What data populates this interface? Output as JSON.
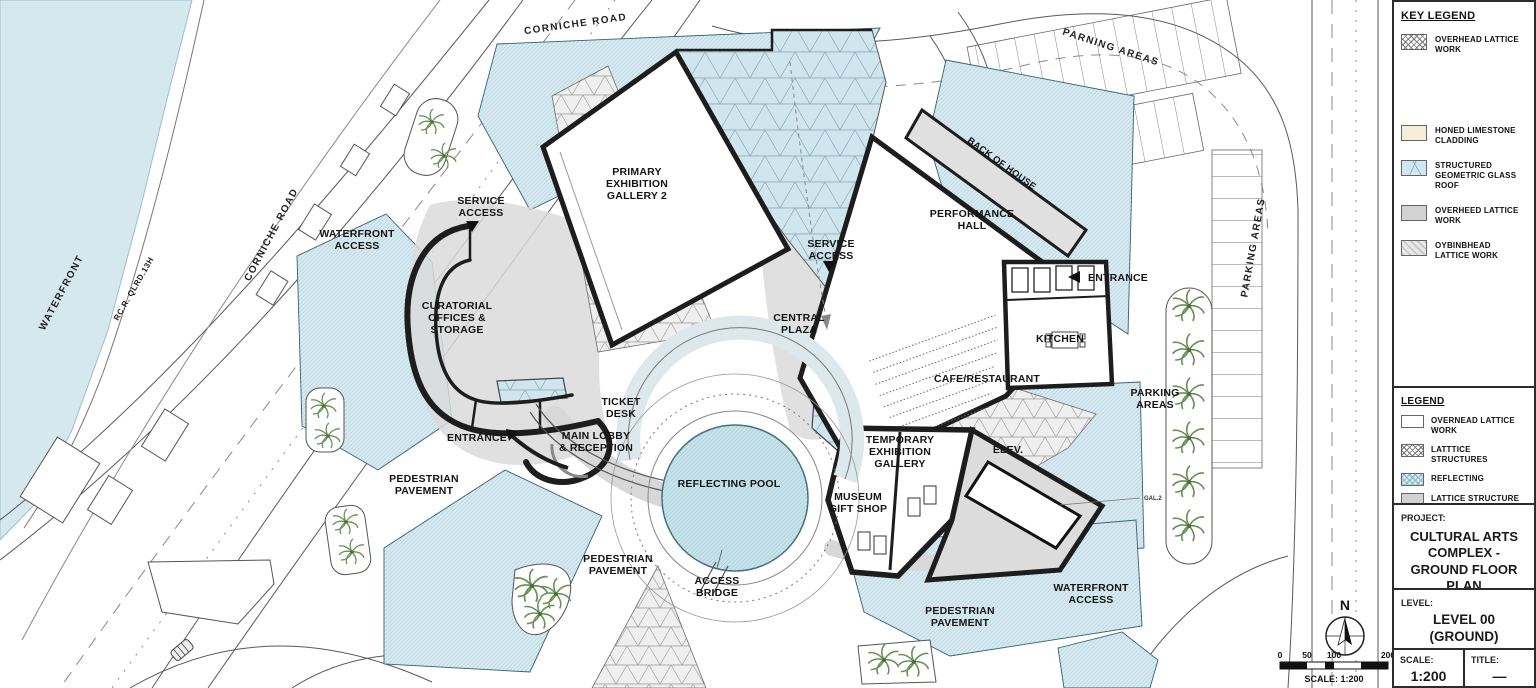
{
  "plan": {
    "labels": {
      "corniche_top": "CORNICHE ROAD",
      "parning_areas": "PARNING AREAS",
      "waterfront": "WATERFRONT",
      "rc_road": "RC.R. QLRD.13H",
      "corniche_left": "CORNICHE ROAD",
      "waterfront_access_nw": "WATERFRONT\nACCESS",
      "service_access_nw": "SERVICE\nACCESS",
      "primary_gallery": "PRIMARY\nEXHIBITION\nGALLERY 2",
      "service_access_c": "SERVICE\nACCESS",
      "performance_hall": "PERFORMANCE\nHALL",
      "back_of_house": "BACK OF HOUSE",
      "entrance_e": "ENTRANCE",
      "kitchen": "KITCHEN",
      "cafe": "CAFE/RESTAURANT",
      "curatorial": "CURATORIAL\nOFFICES &\nSTORAGE",
      "central_plaza": "CENTRAL\nPLAZA",
      "ticket_desk": "TICKET\nDESK",
      "main_lobby": "MAIN LOBBY\n& RECEPTION",
      "entrance_w": "ENTRANCE",
      "ped_pavement_w": "PEDESTRIAN\nPAVEMENT",
      "reflecting_pool": "REFLECTING POOL",
      "temp_gallery": "TEMPORARY\nEXHIBITION\nGALLERY",
      "elev": "ELEV.",
      "gift_shop": "MUSEUM\nGIFT SHOP",
      "parking_e": "PARKING\nAREAS",
      "ped_pavement_s": "PEDESTRIAN\nPAVEMENT",
      "access_bridge": "ACCESS\nBRIDGE",
      "ped_pavement_se": "PEDESTRIAN\nPAVEMENT",
      "waterfront_access_se": "WATERFRONT\nACCESS",
      "parking_right": "PARKING AREAS",
      "gal_tag": "GAL.2"
    },
    "north_label": "N",
    "scale_bar": {
      "ticks": [
        "0",
        "50",
        "100",
        "200"
      ],
      "caption": "SCALE: 1:200"
    }
  },
  "title_block": {
    "key_legend": {
      "title": "KEY LEGEND",
      "items": [
        {
          "label": "OVERHEAD LATTICE WORK",
          "swatch": "crosshatch"
        },
        {
          "label": "HONED LIMESTONE CLADDING",
          "swatch": "limestone"
        },
        {
          "label": "STRUCTURED GEOMETRIC GLASS ROOF",
          "swatch": "glass"
        },
        {
          "label": "OVERHEED LATTICE WORK",
          "swatch": "gray"
        },
        {
          "label": "OYBINBHEAD LATTICE WORK",
          "swatch": "diagonal-hatch"
        }
      ]
    },
    "legend": {
      "title": "LEGEND",
      "items": [
        {
          "label": "OVERNEAD LATTICE WORK",
          "swatch": "white"
        },
        {
          "label": "LATTTICE STRUCTURES",
          "swatch": "crosshatch"
        },
        {
          "label": "REFLECTING",
          "swatch": "blue-hatch"
        },
        {
          "label": "LATTICE STRUCTURE MORK",
          "swatch": "gray"
        }
      ]
    },
    "project": {
      "label": "PROJECT:",
      "value": "CULTURAL ARTS\nCOMPLEX -\nGROUND FLOOR\nPLAN"
    },
    "level": {
      "label": "LEVEL:",
      "value": "LEVEL 00\n(GROUND)"
    },
    "scale": {
      "label": "SCALE:",
      "value": "1:200"
    },
    "title": {
      "label": "TITLE:",
      "value": "—"
    }
  },
  "colors": {
    "water": "#d5e8ee",
    "pavement": "#dcedf3",
    "glass_roof": "#cfe6ef",
    "lattice_bg": "#f0f0f0",
    "wall": "#1d1d1d",
    "limestone": "#f6edd8",
    "gray_roof": "#d4d4d4",
    "palm_green": "#6b8f58"
  }
}
